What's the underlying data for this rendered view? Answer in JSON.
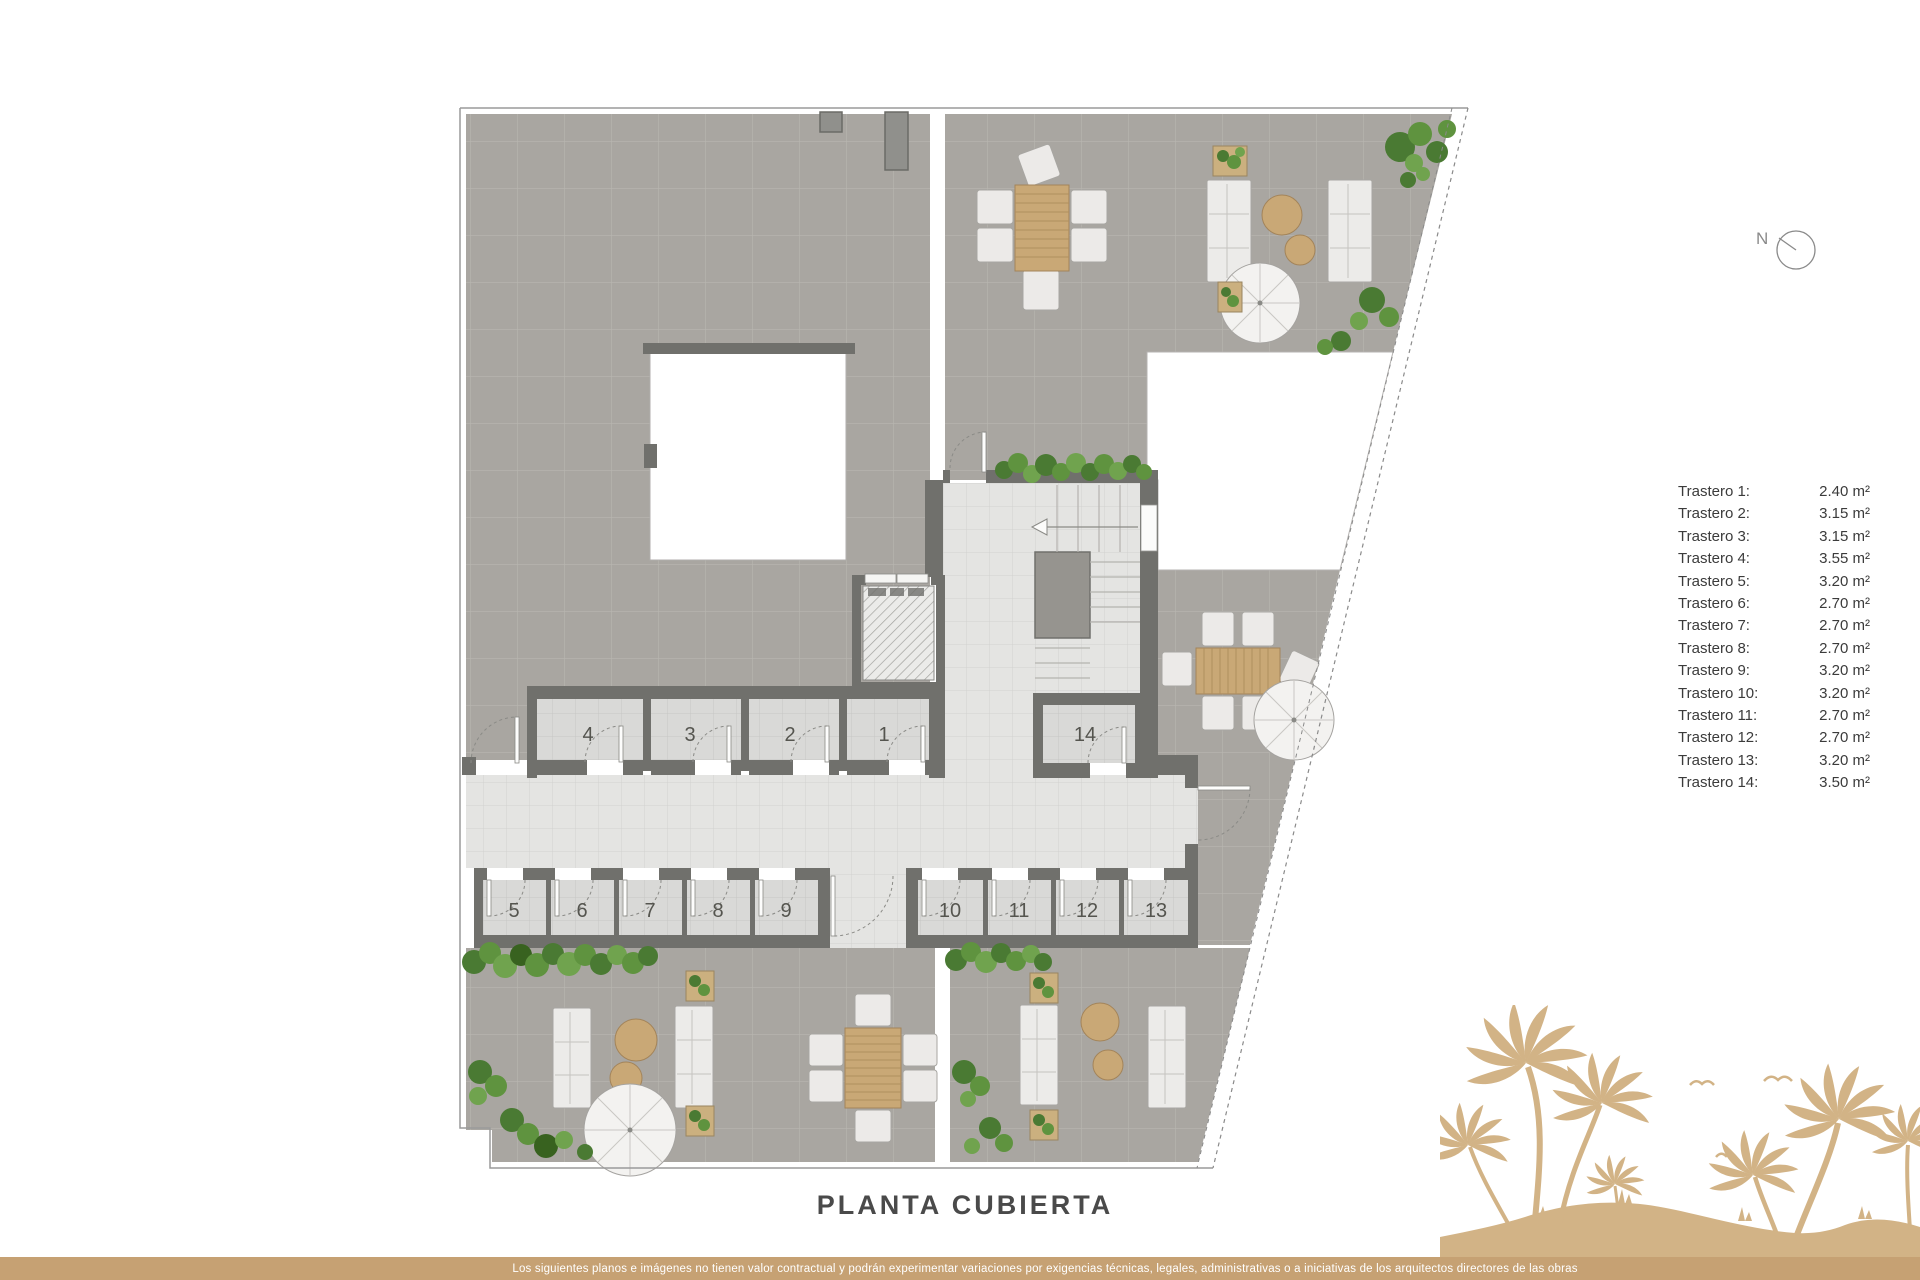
{
  "title": "PLANTA CUBIERTA",
  "compass": {
    "label": "N"
  },
  "legend": {
    "items": [
      {
        "label": "Trastero 1:",
        "area": "2.40 m²"
      },
      {
        "label": "Trastero 2:",
        "area": "3.15 m²"
      },
      {
        "label": "Trastero 3:",
        "area": "3.15 m²"
      },
      {
        "label": "Trastero 4:",
        "area": "3.55 m²"
      },
      {
        "label": "Trastero 5:",
        "area": "3.20 m²"
      },
      {
        "label": "Trastero 6:",
        "area": "2.70 m²"
      },
      {
        "label": "Trastero 7:",
        "area": "2.70 m²"
      },
      {
        "label": "Trastero 8:",
        "area": "2.70 m²"
      },
      {
        "label": "Trastero 9:",
        "area": "3.20 m²"
      },
      {
        "label": "Trastero 10:",
        "area": "3.20 m²"
      },
      {
        "label": "Trastero 11:",
        "area": "2.70 m²"
      },
      {
        "label": "Trastero 12:",
        "area": "2.70 m²"
      },
      {
        "label": "Trastero 13:",
        "area": "3.20 m²"
      },
      {
        "label": "Trastero 14:",
        "area": "3.50 m²"
      }
    ]
  },
  "plan": {
    "rooms": [
      {
        "number": "1"
      },
      {
        "number": "2"
      },
      {
        "number": "3"
      },
      {
        "number": "4"
      },
      {
        "number": "5"
      },
      {
        "number": "6"
      },
      {
        "number": "7"
      },
      {
        "number": "8"
      },
      {
        "number": "9"
      },
      {
        "number": "10"
      },
      {
        "number": "11"
      },
      {
        "number": "12"
      },
      {
        "number": "13"
      },
      {
        "number": "14"
      }
    ]
  },
  "footer": {
    "disclaimer": "Los siguientes planos e imágenes no tienen valor contractual y podrán experimentar variaciones por exigencias técnicas, legales, administrativas o a iniciativas de los arquitectos directores de las obras"
  },
  "colors": {
    "accent_tan": "#c6a173",
    "palm_tan": "#d2b386",
    "wall_gray": "#70706c",
    "terrace_gray": "#a9a6a1",
    "corridor_gray": "#e4e4e2",
    "room_gray": "#d9d9d7",
    "plant_green": "#4a7a33"
  }
}
